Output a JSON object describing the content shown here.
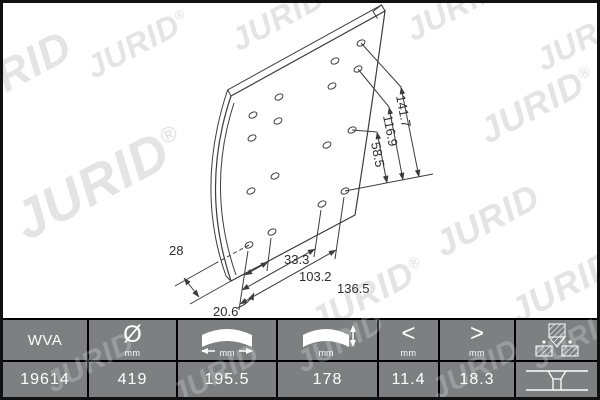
{
  "brand": {
    "watermark": "JURID",
    "registered": "®"
  },
  "drawing": {
    "dims": {
      "d28": "28",
      "d33": "33.3",
      "d103": "103.2",
      "d136": "136.5",
      "d20": "20.6",
      "d58": "58.5",
      "d116": "116.9",
      "d141": "141.7"
    }
  },
  "table": {
    "units_label": "mm",
    "headers": {
      "wva": "WVA",
      "diameter_symbol": "Ø",
      "min_symbol": "<",
      "max_symbol": ">"
    },
    "icons": {
      "col3": "lining-width-icon",
      "col4": "lining-thickness-icon",
      "col7": "rivet-icon",
      "row7": "countersunk-hole-icon"
    },
    "row": {
      "wva": "19614",
      "diameter": "419",
      "width": "195.5",
      "thickness": "178",
      "min": "11.4",
      "max": "18.3"
    }
  },
  "colors": {
    "table_bg": "#7e7f80",
    "table_text": "#ffffff",
    "border": "#000000",
    "line": "#3c3c3c",
    "watermark": "#e4e4e4"
  }
}
